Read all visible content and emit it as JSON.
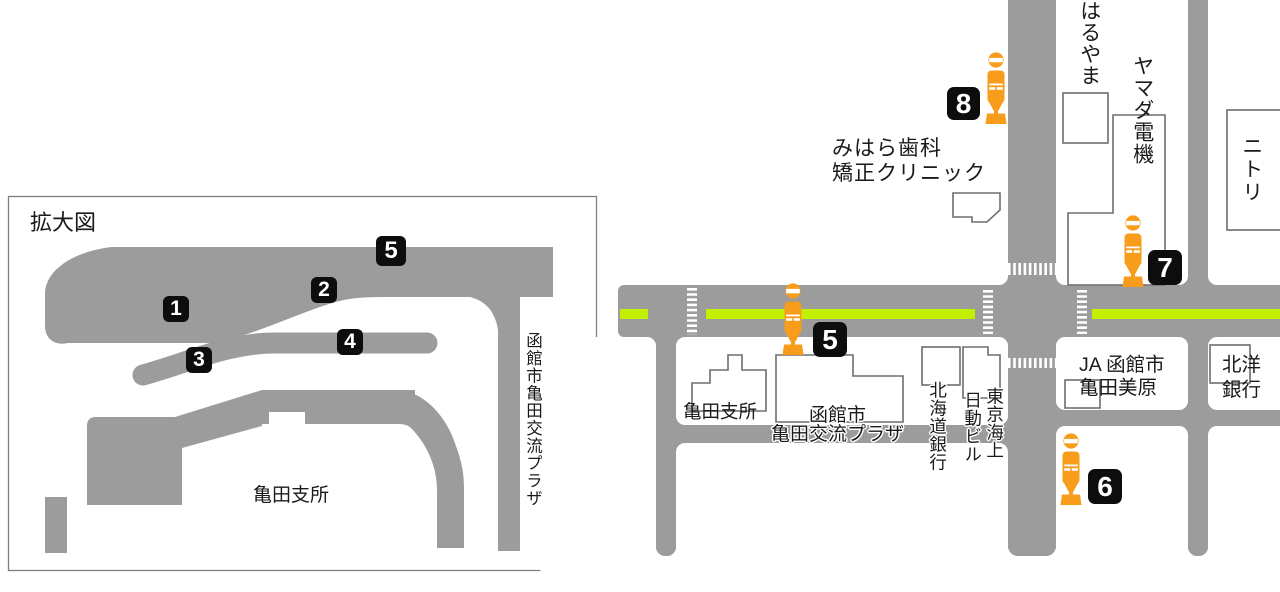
{
  "colors": {
    "road": "#9c9c9c",
    "green": "#c3f000",
    "orange": "#f79d1b",
    "badge-bg": "#0d0d0d",
    "badge-fg": "#ffffff",
    "outline": "#6e6e6e",
    "ink": "#1a1a1a",
    "frame": "#7f7f7f"
  },
  "inset": {
    "title": "拡大図",
    "office_label": "亀田支所",
    "plaza_vertical_label": "函館市亀田交流プラザ",
    "stops": [
      "1",
      "2",
      "3",
      "4",
      "5"
    ]
  },
  "map": {
    "stops": [
      "5",
      "6",
      "7",
      "8"
    ],
    "labels": {
      "haruyama": "はるやま",
      "yamada_denki": "ヤマダ電機",
      "nitori": "ニトリ",
      "mihara_line1": "みはら歯科",
      "mihara_line2": "矯正クリニック",
      "kameda_office": "亀田支所",
      "plaza_line1": "函館市",
      "plaza_line2": "亀田交流プラザ",
      "hokkaido_bank": "北海道銀行",
      "tokio_marine_right": "東京海上",
      "tokio_marine_left": "日動ビル",
      "ja_line1": "JA 函館市",
      "ja_line2": "亀田美原",
      "hokuyo_line1": "北洋",
      "hokuyo_line2": "銀行"
    }
  }
}
